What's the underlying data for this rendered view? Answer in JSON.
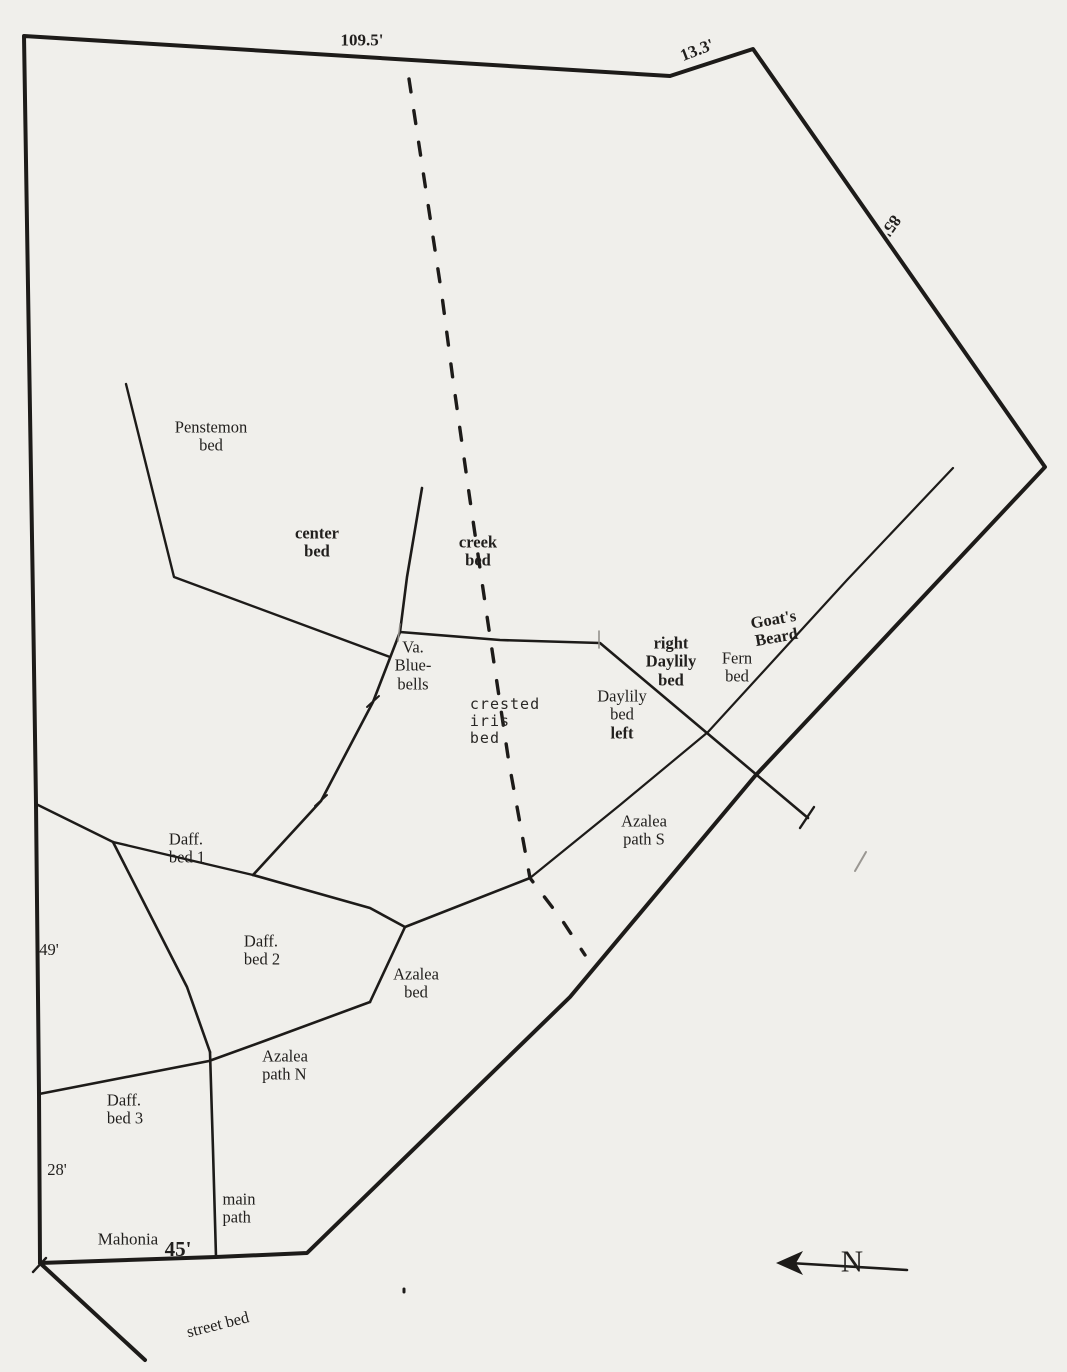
{
  "map": {
    "title": "hand-drawn garden plot plan",
    "paper_color": "#f0efeb",
    "line_color": "#1d1b19",
    "text_color": "#211f1d",
    "creek_dash": "13 19",
    "lines": [
      {
        "id": "property-boundary-line",
        "points": [
          [
            24,
            36
          ],
          [
            670,
            76
          ],
          [
            753,
            49
          ],
          [
            1045,
            467
          ],
          [
            755,
            776
          ],
          [
            570,
            997
          ],
          [
            307,
            1253
          ],
          [
            216,
            1257
          ],
          [
            40,
            1263
          ],
          [
            39,
            1094
          ],
          [
            36,
            804
          ],
          [
            33,
            600
          ],
          [
            24,
            36
          ]
        ],
        "width": 4
      },
      {
        "id": "street-bed-line",
        "points": [
          [
            40,
            1263
          ],
          [
            145,
            1360
          ]
        ],
        "width": 4
      },
      {
        "id": "penstemon-bed-line",
        "points": [
          [
            126,
            384
          ],
          [
            174,
            577
          ],
          [
            390,
            657
          ]
        ],
        "width": 2.4
      },
      {
        "id": "center-path-line",
        "points": [
          [
            422,
            488
          ],
          [
            407,
            577
          ],
          [
            400,
            632
          ]
        ],
        "width": 2.6
      },
      {
        "id": "daylily-bed-line",
        "points": [
          [
            400,
            632
          ],
          [
            500,
            640
          ],
          [
            600,
            643
          ],
          [
            808,
            818
          ]
        ],
        "width": 2.6
      },
      {
        "id": "bluebells-path-line",
        "points": [
          [
            400,
            632
          ],
          [
            373,
            702
          ],
          [
            321,
            801
          ],
          [
            253,
            875
          ]
        ],
        "width": 2.6
      },
      {
        "id": "daff-bed1-top-line",
        "points": [
          [
            36,
            804
          ],
          [
            113,
            842
          ],
          [
            253,
            875
          ]
        ],
        "width": 2.4
      },
      {
        "id": "daff-divider-line",
        "points": [
          [
            113,
            842
          ],
          [
            187,
            987
          ],
          [
            210,
            1052
          ]
        ],
        "width": 2.6
      },
      {
        "id": "azalea-bed-top-line",
        "points": [
          [
            253,
            875
          ],
          [
            370,
            908
          ],
          [
            405,
            927
          ],
          [
            530,
            878
          ]
        ],
        "width": 2.6
      },
      {
        "id": "azalea-path-s-line",
        "points": [
          [
            530,
            878
          ],
          [
            620,
            805
          ],
          [
            708,
            732
          ],
          [
            847,
            580
          ],
          [
            953,
            468
          ]
        ],
        "width": 2.2
      },
      {
        "id": "azalea-bed-left-line",
        "points": [
          [
            405,
            927
          ],
          [
            370,
            1002
          ]
        ],
        "width": 2.6
      },
      {
        "id": "azalea-path-n-line",
        "points": [
          [
            370,
            1002
          ],
          [
            267,
            1040
          ],
          [
            209,
            1061
          ],
          [
            39,
            1094
          ]
        ],
        "width": 2.6
      },
      {
        "id": "main-path-line",
        "points": [
          [
            210,
            1052
          ],
          [
            213,
            1150
          ],
          [
            216,
            1257
          ]
        ],
        "width": 2.6
      },
      {
        "id": "creek-line",
        "points": [
          [
            409,
            79
          ],
          [
            442,
            296
          ],
          [
            453,
            380
          ],
          [
            470,
            500
          ],
          [
            488,
            623
          ],
          [
            509,
            763
          ],
          [
            530,
            878
          ],
          [
            562,
            920
          ],
          [
            585,
            955
          ]
        ],
        "width": 3.4,
        "dashed": true
      },
      {
        "id": "north-arrow-shaft",
        "points": [
          [
            790,
            1263
          ],
          [
            907,
            1270
          ]
        ],
        "width": 2.6
      },
      {
        "id": "tick-path-1",
        "points": [
          [
            367,
            707
          ],
          [
            379,
            696
          ]
        ],
        "width": 2
      },
      {
        "id": "tick-path-2",
        "points": [
          [
            315,
            806
          ],
          [
            327,
            795
          ]
        ],
        "width": 2
      },
      {
        "id": "tick-daylily-end",
        "points": [
          [
            800,
            828
          ],
          [
            814,
            807
          ]
        ],
        "width": 2.4
      },
      {
        "id": "tick-gray-1",
        "points": [
          [
            855,
            871
          ],
          [
            866,
            852
          ]
        ],
        "width": 2,
        "color": "#9a9792"
      },
      {
        "id": "tick-corner",
        "points": [
          [
            33,
            1272
          ],
          [
            46,
            1258
          ]
        ],
        "width": 2.4
      },
      {
        "id": "tick-junction-1",
        "points": [
          [
            400,
            624
          ],
          [
            398,
            641
          ]
        ],
        "width": 1.5,
        "color": "#8e8b86"
      },
      {
        "id": "tick-junction-2",
        "points": [
          [
            599,
            631
          ],
          [
            599,
            648
          ]
        ],
        "width": 1.5,
        "color": "#8e8b86"
      },
      {
        "id": "stray-dot",
        "points": [
          [
            404,
            1289
          ],
          [
            404,
            1292
          ]
        ],
        "width": 3
      }
    ],
    "north_arrow_head": {
      "id": "north-arrow-head",
      "points": [
        [
          776,
          1263
        ],
        [
          803,
          1251
        ],
        [
          796,
          1263
        ],
        [
          803,
          1275
        ]
      ]
    },
    "labels": [
      {
        "id": "dim-109-5",
        "lines": [
          "109.5'"
        ],
        "x": 362,
        "y": 40,
        "bold": true,
        "size": 17
      },
      {
        "id": "dim-13-3",
        "lines": [
          "13.3'"
        ],
        "x": 697,
        "y": 50,
        "bold": true,
        "size": 17,
        "rotate": -21
      },
      {
        "id": "dim-85",
        "lines": [
          "85'"
        ],
        "x": 891,
        "y": 226,
        "bold": true,
        "size": 17,
        "rotate": 125
      },
      {
        "id": "penstemon-bed-label",
        "lines": [
          "Penstemon",
          "bed"
        ],
        "x": 211,
        "y": 437
      },
      {
        "id": "center-bed-label",
        "lines": [
          "center",
          "bed"
        ],
        "x": 317,
        "y": 543,
        "bold": true
      },
      {
        "id": "creek-bed-label",
        "lines": [
          "creek",
          "bed"
        ],
        "x": 478,
        "y": 552,
        "bold": true
      },
      {
        "id": "va-bluebells-label",
        "lines": [
          "Va.",
          "Blue-",
          "bells"
        ],
        "x": 413,
        "y": 666
      },
      {
        "id": "crested-iris-bed-label",
        "lines": [
          "crested",
          "iris",
          "bed"
        ],
        "x": 505,
        "y": 721,
        "hand": true,
        "align": "left"
      },
      {
        "id": "daylily-bed-left-label",
        "lines": [
          "Daylily",
          "bed",
          "left"
        ],
        "x": 622,
        "y": 715,
        "bold_lines": [
          2
        ]
      },
      {
        "id": "right-daylily-bed-label",
        "lines": [
          "right",
          "Daylily",
          "bed"
        ],
        "x": 671,
        "y": 662,
        "bold": true
      },
      {
        "id": "fern-bed-label",
        "lines": [
          "Fern",
          "bed"
        ],
        "x": 737,
        "y": 668
      },
      {
        "id": "goats-beard-label",
        "lines": [
          "Goat's",
          "Beard"
        ],
        "x": 775,
        "y": 629,
        "bold": true,
        "rotate": -10
      },
      {
        "id": "azalea-path-s-label",
        "lines": [
          "Azalea",
          "path S"
        ],
        "x": 644,
        "y": 831
      },
      {
        "id": "daff-bed-1-label",
        "lines": [
          "Daff.",
          "bed 1"
        ],
        "x": 187,
        "y": 849,
        "align": "left"
      },
      {
        "id": "daff-bed-2-label",
        "lines": [
          "Daff.",
          "bed 2"
        ],
        "x": 262,
        "y": 951,
        "align": "left"
      },
      {
        "id": "azalea-bed-label",
        "lines": [
          "Azalea",
          "bed"
        ],
        "x": 416,
        "y": 984
      },
      {
        "id": "azalea-path-n-label",
        "lines": [
          "Azalea",
          "path N"
        ],
        "x": 285,
        "y": 1066,
        "align": "left"
      },
      {
        "id": "daff-bed-3-label",
        "lines": [
          "Daff.",
          "bed 3"
        ],
        "x": 125,
        "y": 1110,
        "align": "left"
      },
      {
        "id": "dim-49",
        "lines": [
          "49'"
        ],
        "x": 49,
        "y": 950
      },
      {
        "id": "dim-28",
        "lines": [
          "28'"
        ],
        "x": 57,
        "y": 1170
      },
      {
        "id": "main-path-label",
        "lines": [
          "main",
          "path"
        ],
        "x": 239,
        "y": 1209,
        "align": "left"
      },
      {
        "id": "mahonia-label",
        "lines": [
          "Mahonia"
        ],
        "x": 128,
        "y": 1239,
        "size": 17
      },
      {
        "id": "dim-45",
        "lines": [
          "45'"
        ],
        "x": 178,
        "y": 1250,
        "bold": true,
        "size": 21
      },
      {
        "id": "street-bed-label",
        "lines": [
          "street bed"
        ],
        "x": 218,
        "y": 1325,
        "rotate": -14
      },
      {
        "id": "north-label",
        "lines": [
          "N"
        ],
        "x": 852,
        "y": 1262,
        "size": 31
      }
    ]
  }
}
